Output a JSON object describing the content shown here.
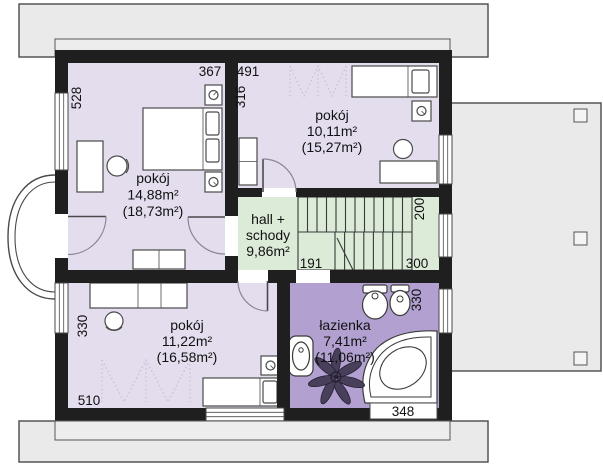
{
  "plan_title": "rzut pietra - floor plan",
  "rooms": {
    "bedroom_large": {
      "label": "pokój",
      "area": "14,88m²",
      "area_total": "(18,73m²)"
    },
    "bedroom_top_right": {
      "label": "pokój",
      "area": "10,11m²",
      "area_total": "(15,27m²)"
    },
    "hall": {
      "line1": "hall +",
      "line2": "schody",
      "area": "9,86m²"
    },
    "bedroom_bottom": {
      "label": "pokój",
      "area": "11,22m²",
      "area_total": "(16,58m²)"
    },
    "bathroom": {
      "label": "łazienka",
      "area": "7,41m²",
      "area_total": "(11,06m²)"
    }
  },
  "dimensions_cm": {
    "left_wall": "528",
    "room1_width": "367",
    "room2_width": "491",
    "room2_left": "316",
    "stairs_side": "200",
    "hall_bottom": "300",
    "hall_left": "191",
    "bath_side": "330",
    "room3_side": "330",
    "room3_bottom": "510",
    "bath_bottom_window": "348"
  },
  "colors": {
    "room_fill": "#e4ddee",
    "bathroom_fill": "#b2a0d0",
    "hall_fill": "#dcead8",
    "roof_fill": "#eaeaea",
    "terrace_fill": "#eaeaea",
    "wall": "#1f1f1f"
  }
}
